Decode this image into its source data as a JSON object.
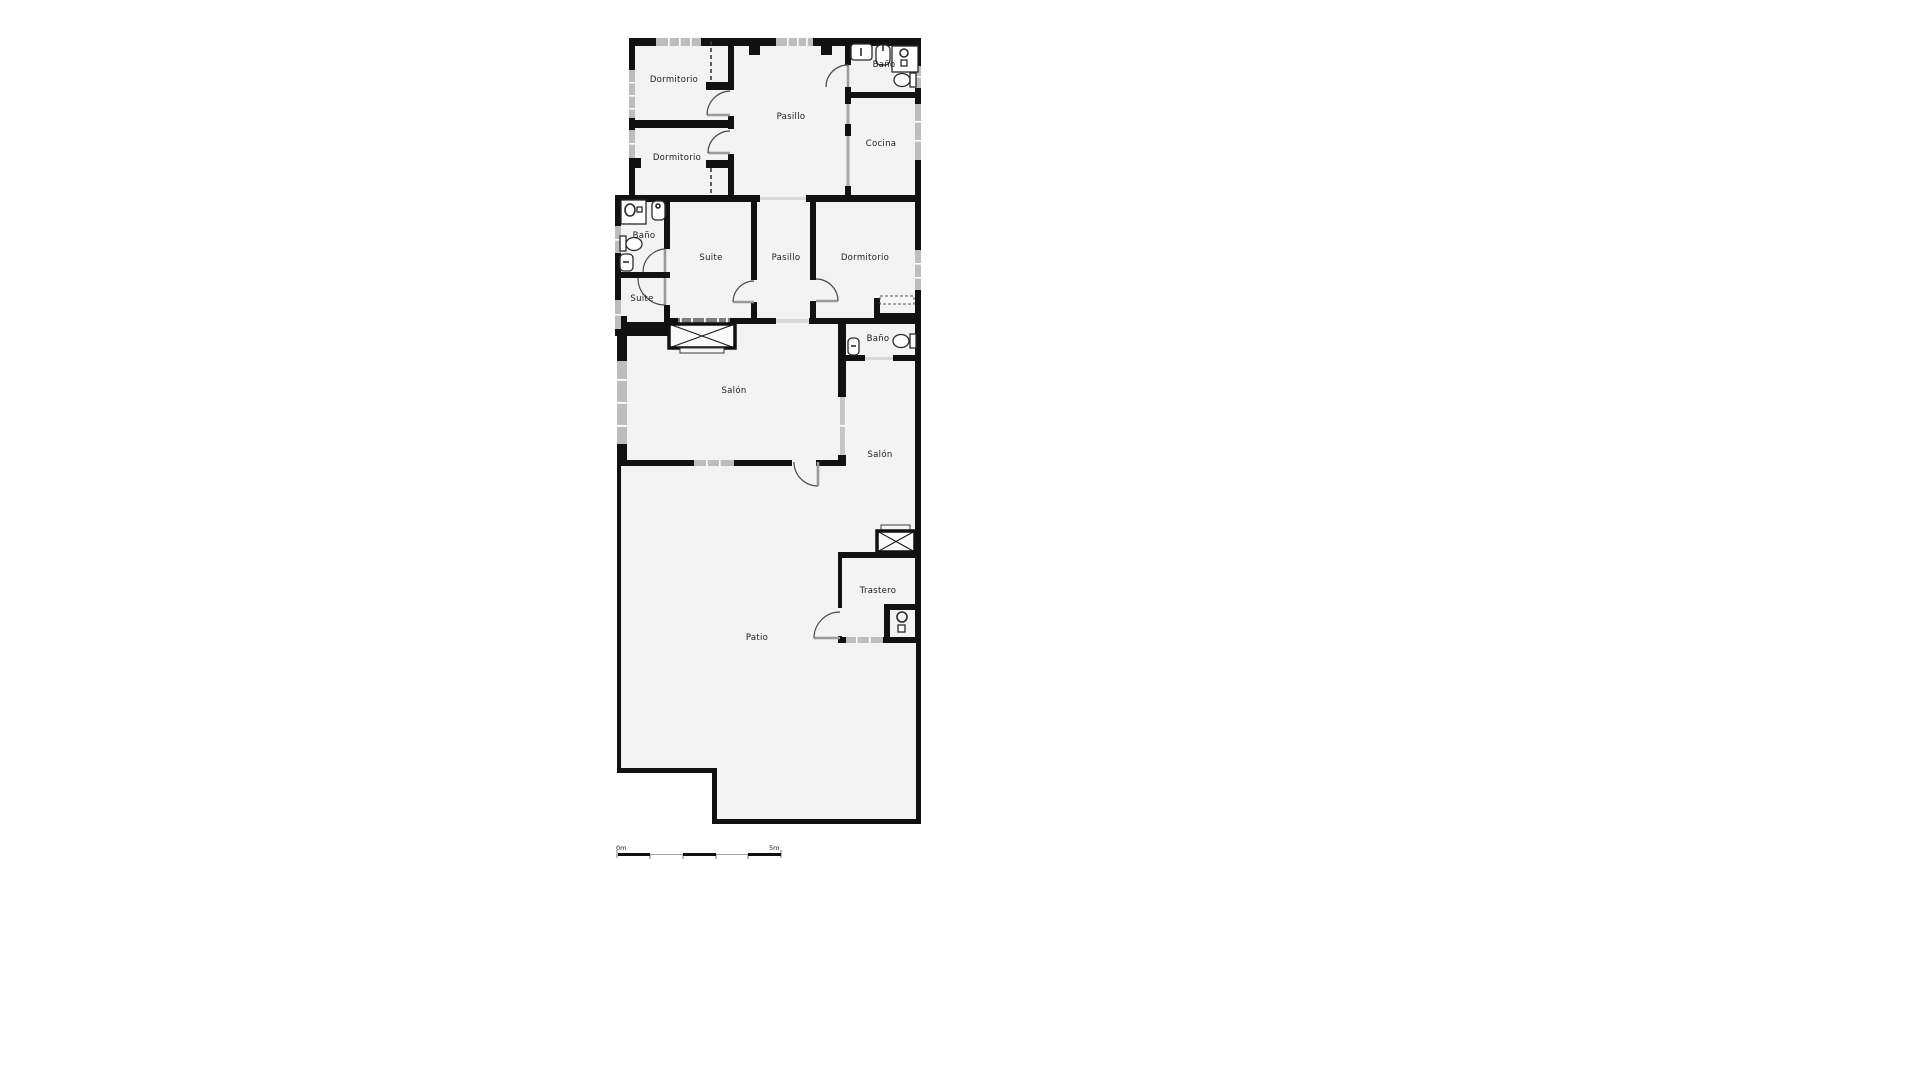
{
  "rooms": [
    {
      "id": "dormitorio-1",
      "label": "Dormitorio"
    },
    {
      "id": "dormitorio-2",
      "label": "Dormitorio"
    },
    {
      "id": "pasillo-top",
      "label": "Pasillo"
    },
    {
      "id": "bano-top",
      "label": "Baño"
    },
    {
      "id": "cocina",
      "label": "Cocina"
    },
    {
      "id": "bano-left",
      "label": "Baño"
    },
    {
      "id": "suite",
      "label": "Suite"
    },
    {
      "id": "pasillo-mid",
      "label": "Pasillo"
    },
    {
      "id": "dormitorio-3",
      "label": "Dormitorio"
    },
    {
      "id": "suite-small",
      "label": "Suite"
    },
    {
      "id": "bano-right",
      "label": "Baño"
    },
    {
      "id": "salon",
      "label": "Salón"
    },
    {
      "id": "salon-right",
      "label": "Salón"
    },
    {
      "id": "trastero",
      "label": "Trastero"
    },
    {
      "id": "patio",
      "label": "Patio"
    }
  ],
  "scale_bar": {
    "start_label": "0m",
    "end_label": "5m"
  },
  "fixtures": [
    "sink",
    "washbasin",
    "shower-tray",
    "toilet",
    "washing-machine",
    "wardrobe-x-box"
  ],
  "colors": {
    "wall": "#111111",
    "room_fill": "#f3f3f3",
    "window": "#bdbdbd",
    "background": "#ffffff"
  }
}
